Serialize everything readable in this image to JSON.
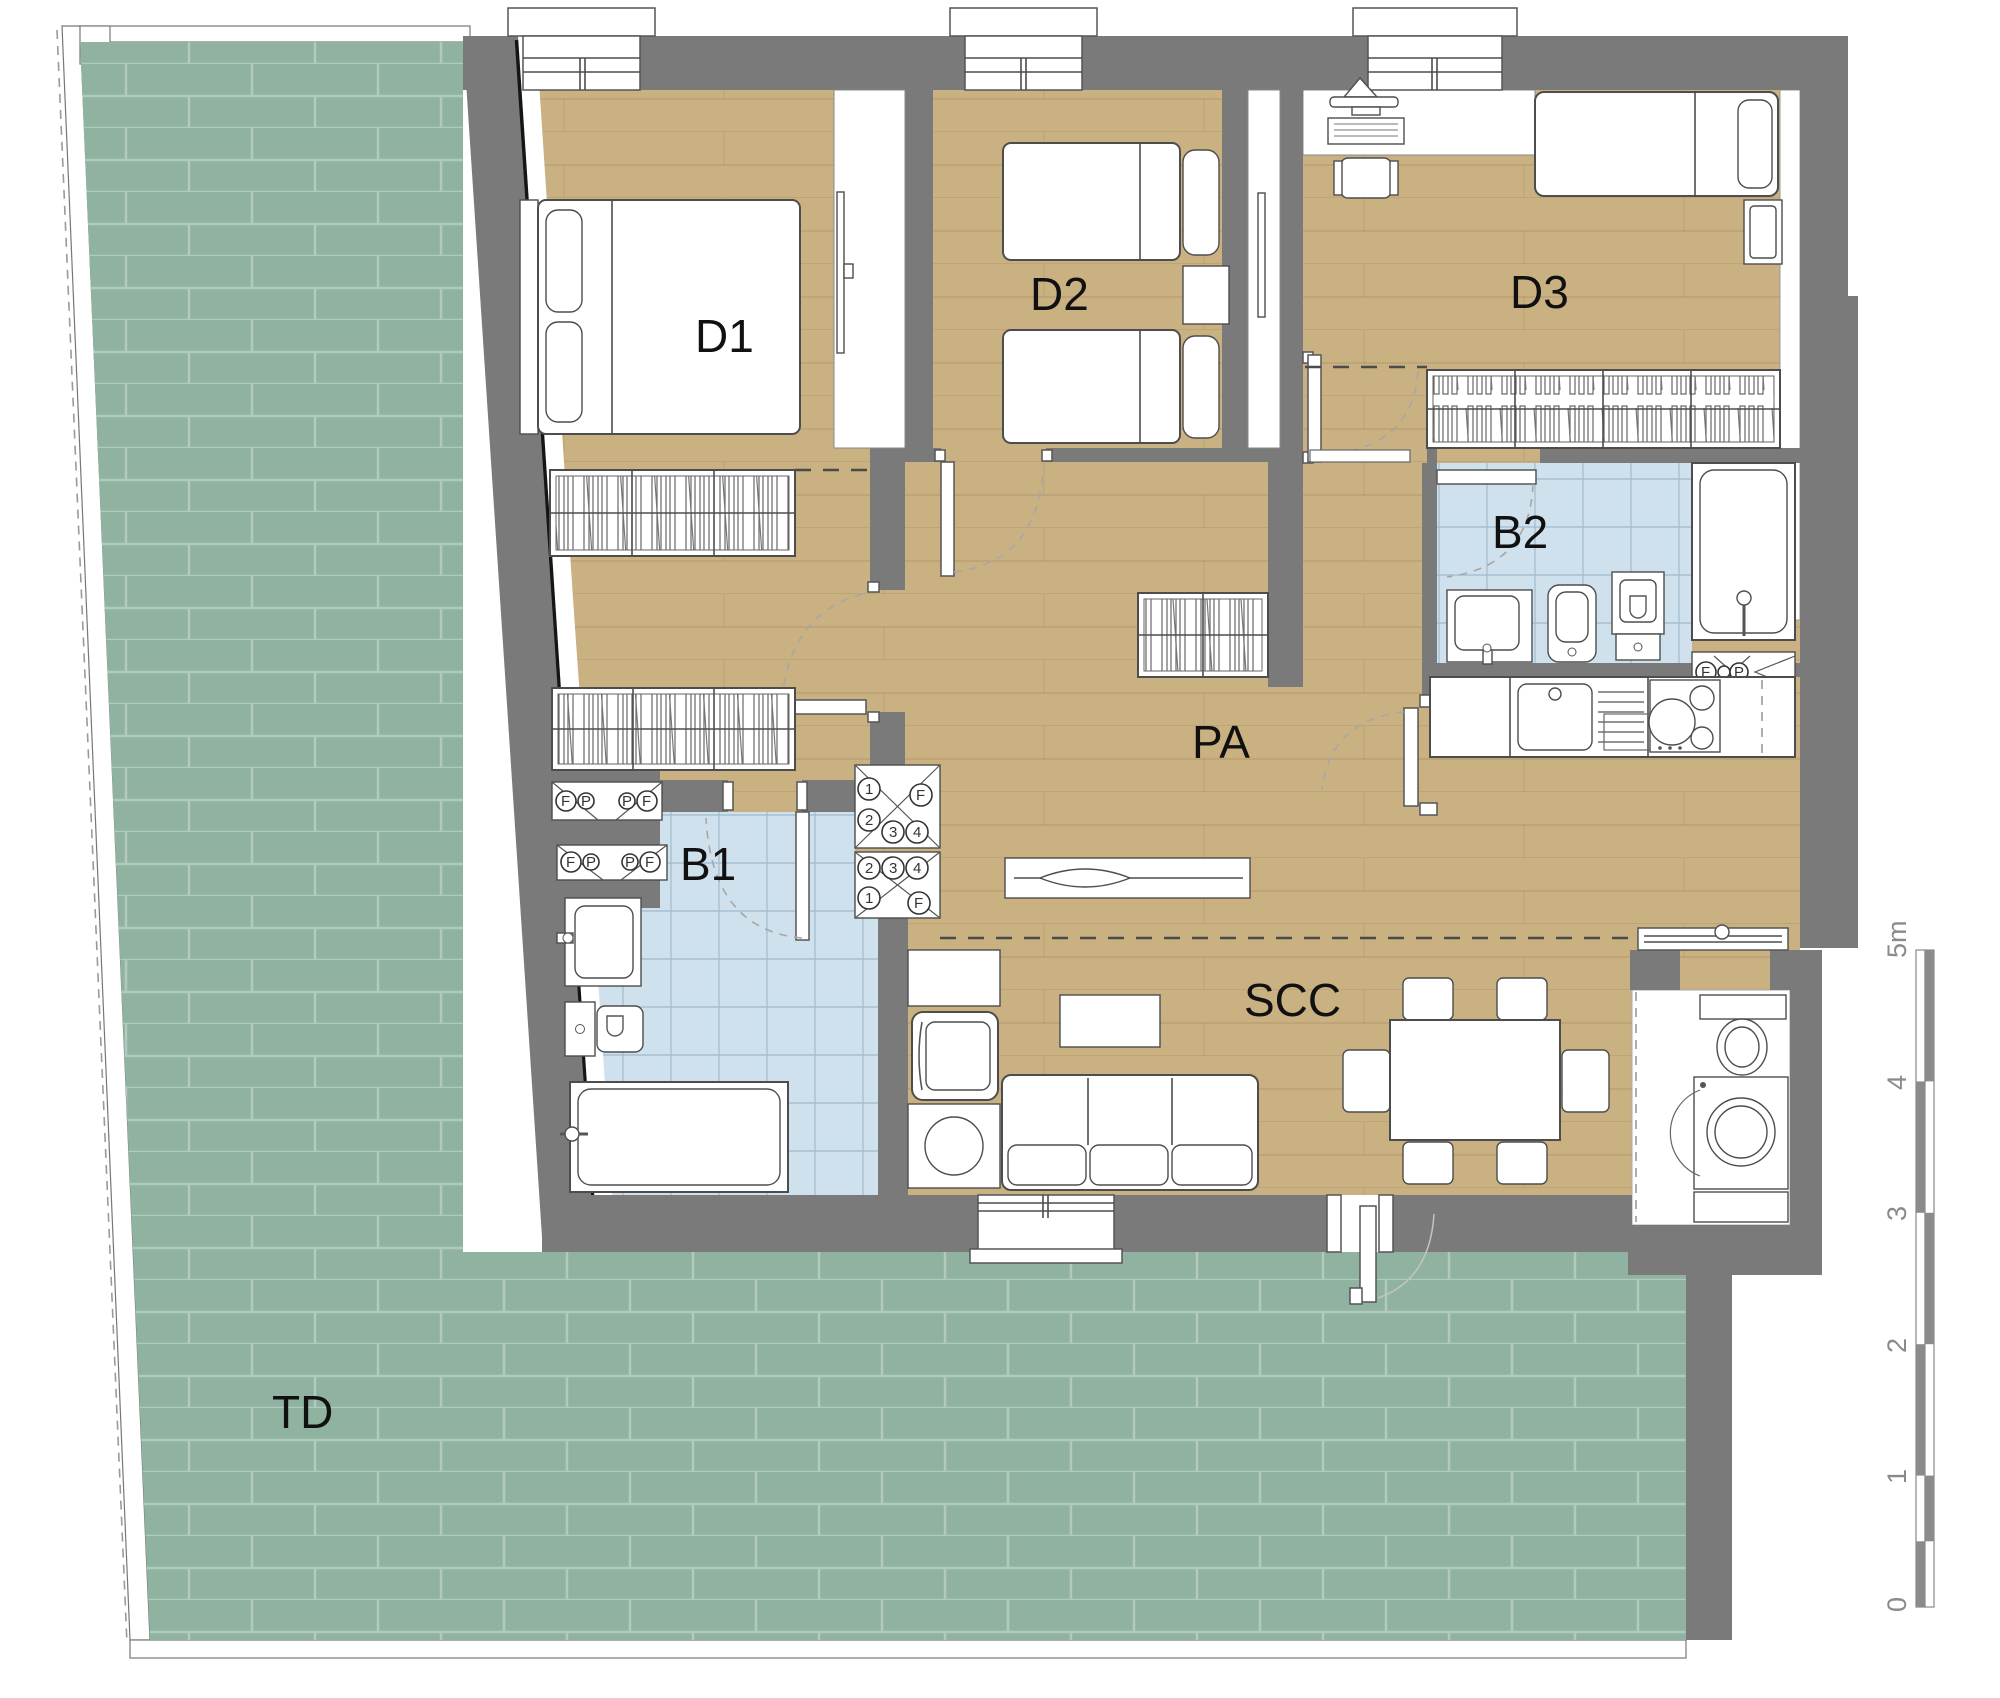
{
  "plan": {
    "type": "apartment-floor-plan",
    "rooms": {
      "d1": "D1",
      "d2": "D2",
      "d3": "D3",
      "b1": "B1",
      "b2": "B2",
      "pa": "PA",
      "scc": "SCC",
      "td": "TD"
    },
    "scalebar": {
      "labels": [
        "0",
        "1",
        "2",
        "3",
        "4",
        "5m"
      ]
    },
    "meters": {
      "niche_upper": [
        "F",
        "P",
        "P",
        "F"
      ],
      "niche_lower": [
        "F",
        "P",
        "P",
        "F"
      ],
      "panel_upper": [
        "1",
        "2",
        "3",
        "4",
        "F"
      ],
      "panel_lower": [
        "2",
        "3",
        "4",
        "1",
        "F"
      ],
      "b2_panel": [
        "F",
        "P"
      ]
    },
    "colors": {
      "terrace": "#8fb3a0",
      "terrace_line": "rgba(255,255,255,0.30)",
      "wood": "#c9b181",
      "tile": "#cfe1ec",
      "wall": "#7a7a7a",
      "line": "#4d4d4d",
      "label": "#111111",
      "scale_text": "#8a8a8a"
    }
  }
}
